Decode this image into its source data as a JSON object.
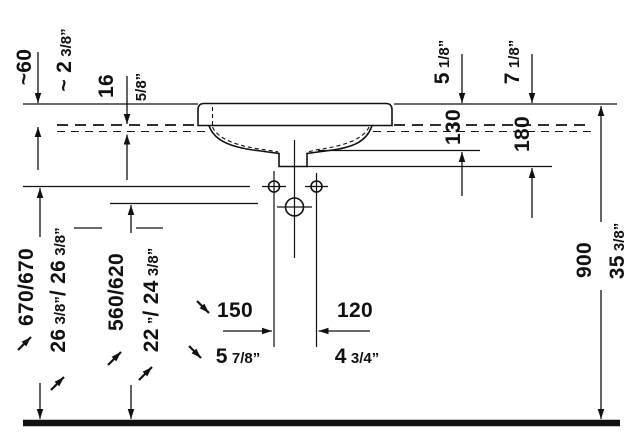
{
  "diagram": {
    "kind": "washbasin installation dimension drawing",
    "background_color": "#ffffff",
    "line_color": "#111111",
    "icons": [
      "adjustable-dimension-diagonal-arrow"
    ],
    "dims": {
      "d60": {
        "mm": "~60",
        "inch_main": "~ 2",
        "inch_frac": " 3/8”"
      },
      "d16": {
        "mm": "16",
        "inch_frac": "5/8”"
      },
      "d130": {
        "mm": "130",
        "inch_main": "5",
        "inch_frac": " 1/8”"
      },
      "d180": {
        "mm": "180",
        "inch_main": "7",
        "inch_frac": " 1/8”"
      },
      "d900": {
        "mm": "900",
        "inch_main": "35",
        "inch_frac": " 3/8”"
      },
      "d670": {
        "mm": "670/670",
        "inch_main1": "26",
        "inch_frac1": " 3/8”",
        "inch_main2": "/ 26",
        "inch_frac2": " 3/8”"
      },
      "d560": {
        "mm": "560/620",
        "inch_main1": "22",
        "inch_frac1": " ”",
        "inch_main2": "/ 24",
        "inch_frac2": " 3/8”"
      },
      "d150": {
        "mm": "150",
        "inch_main": "5",
        "inch_frac": " 7/8”"
      },
      "d120": {
        "mm": "120",
        "inch_main": "4",
        "inch_frac": " 3/4”"
      }
    }
  }
}
